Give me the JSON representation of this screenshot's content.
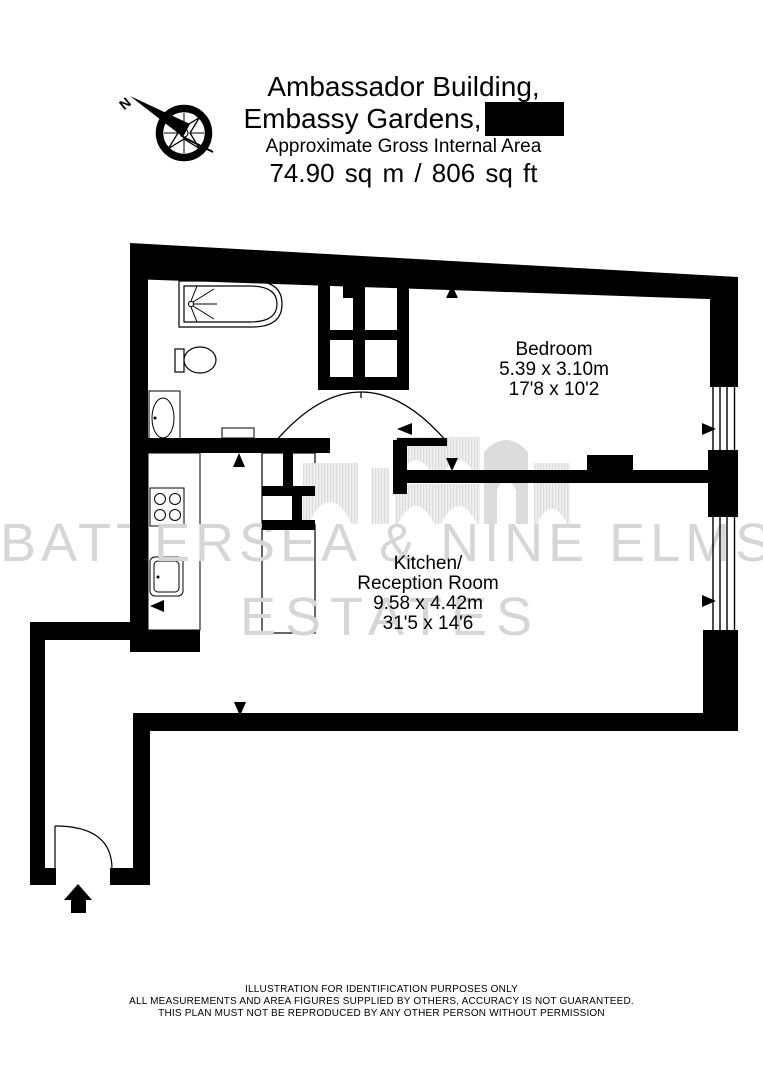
{
  "header": {
    "building": "Ambassador Building,",
    "development": "Embassy Gardens,",
    "area_caption": "Approximate Gross Internal Area",
    "area_value": "74.90 sq m / 806 sq ft"
  },
  "compass": {
    "north_label": "N"
  },
  "rooms": {
    "bedroom": {
      "name": "Bedroom",
      "size_metric": "5.39 x 3.10m",
      "size_imperial": "17'8 x 10'2"
    },
    "kitchen_reception": {
      "name_line1": "Kitchen/",
      "name_line2": "Reception Room",
      "size_metric": "9.58 x 4.42m",
      "size_imperial": "31'5 x 14'6"
    }
  },
  "watermark": {
    "line1": "BATTERSEA & NINE ELMS",
    "line2": "ESTATES"
  },
  "footer": {
    "line1": "ILLUSTRATION FOR IDENTIFICATION PURPOSES ONLY",
    "line2": "ALL MEASUREMENTS AND AREA FIGURES SUPPLIED BY OTHERS, ACCURACY IS NOT GUARANTEED.",
    "line3": "THIS PLAN MUST NOT BE REPRODUCED BY ANY OTHER PERSON WITHOUT PERMISSION"
  },
  "colors": {
    "wall": "#000000",
    "background": "#ffffff",
    "watermark": "#d6d6d6"
  }
}
